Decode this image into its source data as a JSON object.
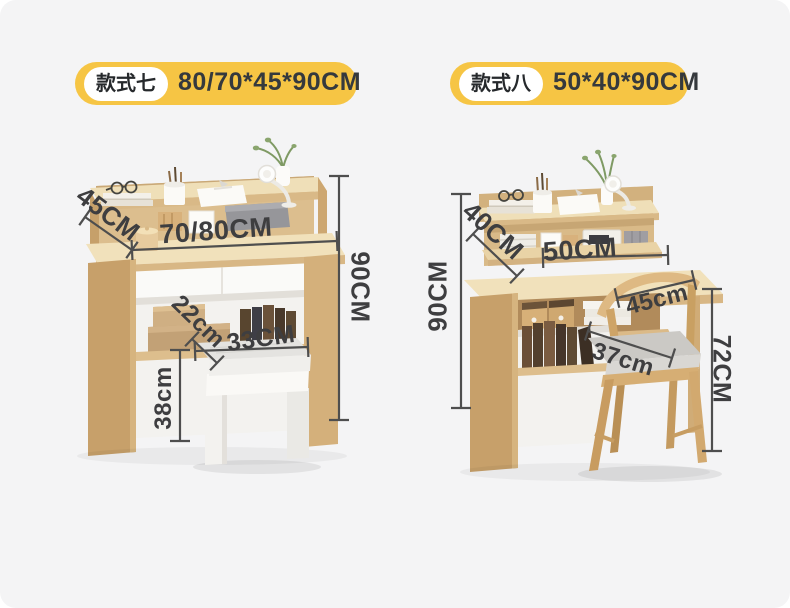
{
  "header": {
    "left_badge": {
      "style_name": "款式七",
      "dimensions": "80/70*45*90CM"
    },
    "right_badge": {
      "style_name": "款式八",
      "dimensions": "50*40*90CM"
    }
  },
  "left_product": {
    "item": "desk-with-hutch-and-stool",
    "labels": {
      "shelf_depth": "45CM",
      "desk_width": "70/80CM",
      "desk_height": "90CM",
      "stool_depth": "22cm",
      "stool_width": "33CM",
      "stool_height": "38cm"
    }
  },
  "right_product": {
    "item": "desk-with-hutch-and-chair",
    "labels": {
      "shelf_depth": "40CM",
      "desk_width": "50CM",
      "desk_height": "90CM",
      "chair_depth": "45cm",
      "seat_width": "37cm",
      "chair_height": "72CM"
    }
  },
  "colors": {
    "background": "#F4F4F5",
    "badge_yellow": "#F6C544",
    "badge_text": "#35393D",
    "dimension_text": "#3E3E40",
    "dimension_line": "#4E4E4E",
    "wood_light": "#F1E1BB",
    "wood_medium": "#D8B785",
    "wood_dark": "#C7A06A"
  }
}
